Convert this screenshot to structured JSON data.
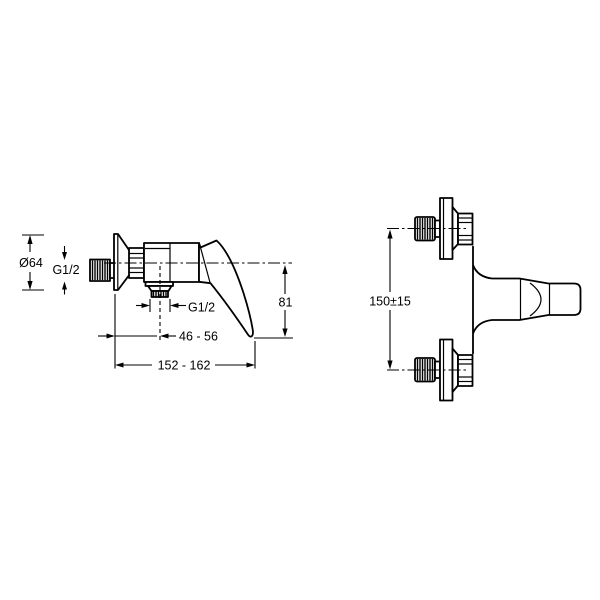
{
  "drawing_type": "technical dimension drawing",
  "colors": {
    "line": "#000000",
    "background": "#ffffff"
  },
  "side_view": {
    "escutcheon_diameter_label": "Ø64",
    "inlet_thread_label": "G1/2",
    "outlet_thread_label": "G1/2",
    "handle_drop_label": "81",
    "outlet_offset_label": "46 - 56",
    "projection_label": "152 - 162"
  },
  "front_view": {
    "connection_spacing_label": "150±15"
  }
}
